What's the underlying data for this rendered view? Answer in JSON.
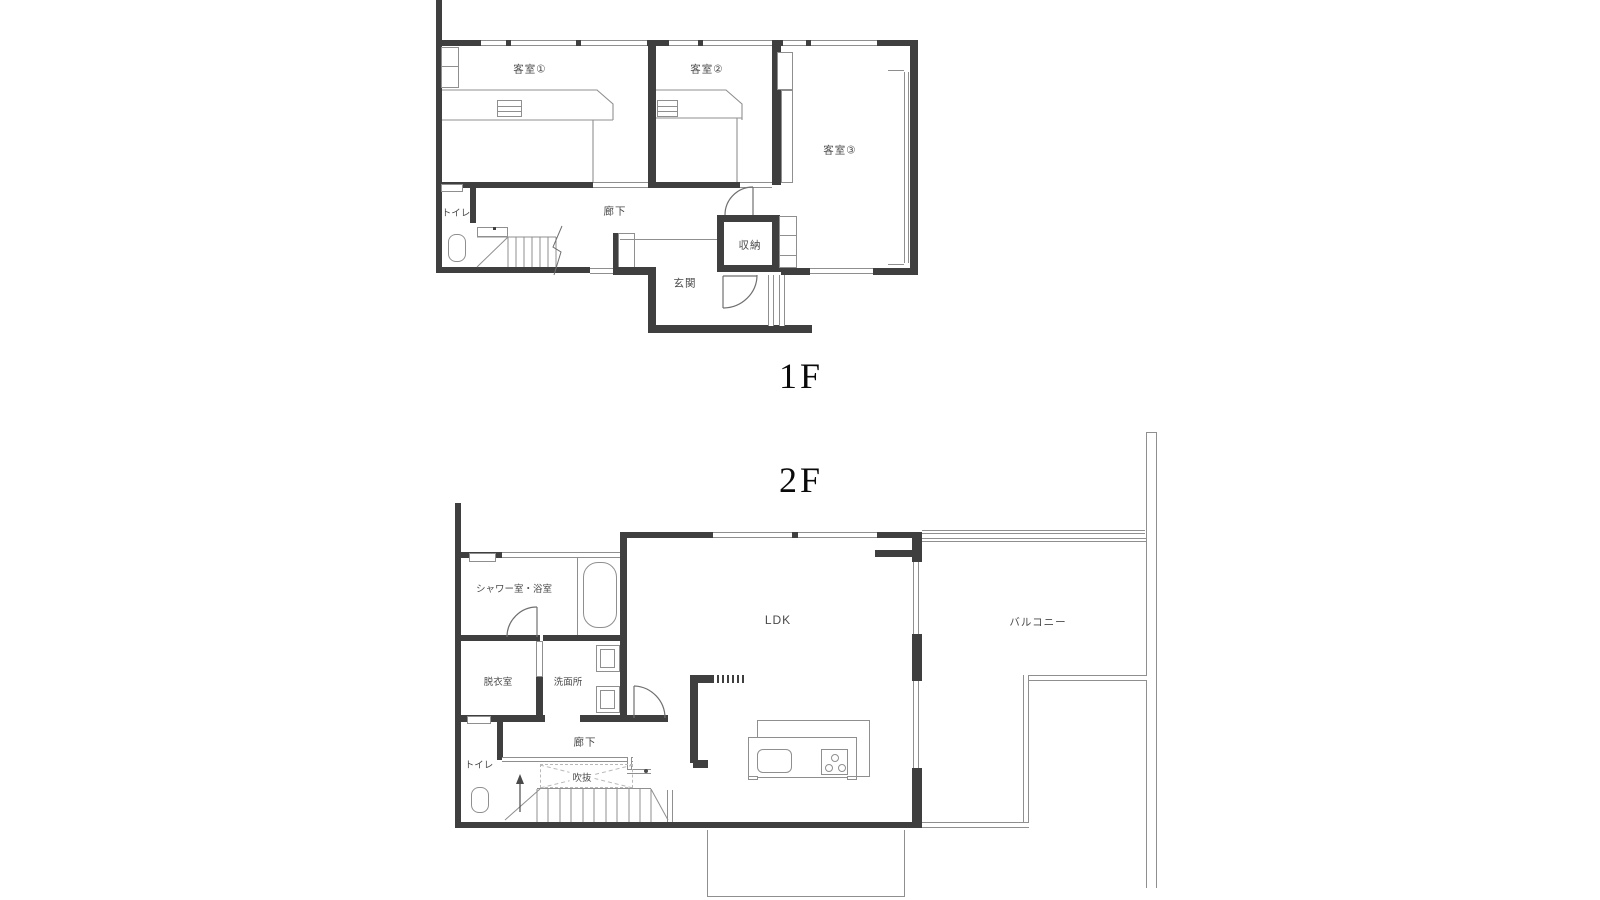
{
  "floor1": {
    "title": "1F",
    "rooms": {
      "guest1": "客室①",
      "guest2": "客室②",
      "guest3": "客室③",
      "toilet": "トイレ",
      "corridor": "廊下",
      "storage": "収納",
      "entrance": "玄関"
    }
  },
  "floor2": {
    "title": "2F",
    "rooms": {
      "shower_bath": "シャワー室・浴室",
      "dressing": "脱衣室",
      "washroom": "洗面所",
      "toilet": "トイレ",
      "corridor": "廊下",
      "void": "吹抜",
      "ldk": "LDK",
      "balcony": "バルコニー"
    }
  },
  "colors": {
    "wall": "#3f3f3f",
    "line": "#8f8f8f",
    "label": "#4a4a4a"
  }
}
